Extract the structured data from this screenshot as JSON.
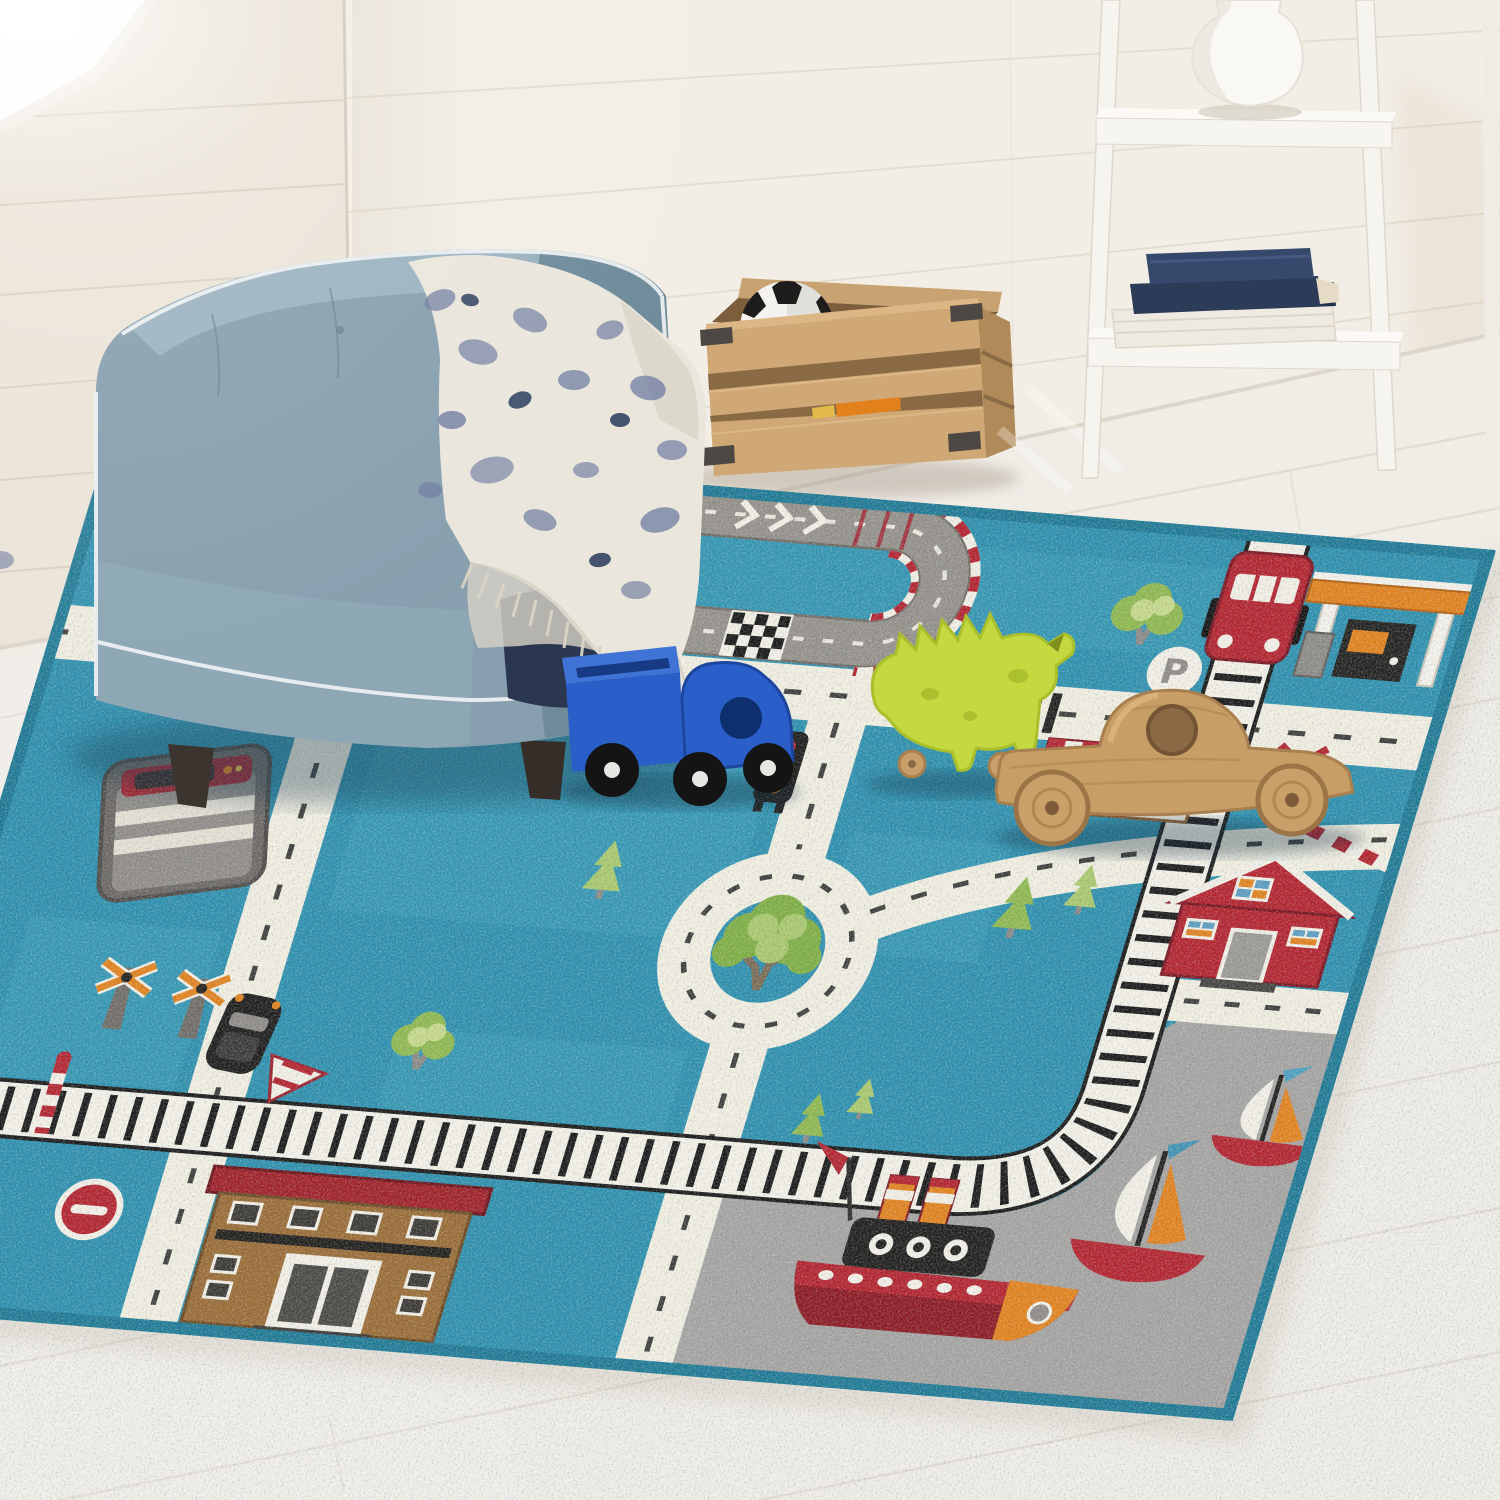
{
  "scene": {
    "label": "Photograph of a children's playroom corner: a teal road-map play rug with toy vehicles on a whitewashed wood floor, beside a light-blue tufted tub armchair with a patterned throw blanket, a wooden storage crate holding a soccer ball, and a white ladder shelf with books and a white vase against white shiplap walls",
    "room": {
      "wall_style": "white shiplap planks",
      "window": "bright daylight entering from upper left",
      "floor": "whitewashed wide wood planks"
    }
  },
  "palette": {
    "wall_left": "#ebe4d8",
    "wall_right": "#f3eee5",
    "floor": "#f0ede7",
    "chair_blue": "#879fae",
    "chair_piping": "#eceff1",
    "blanket_cream": "#eae6dc",
    "blanket_slate": "#6e7ca0",
    "blanket_navy": "#2b3750",
    "crate_wood": "#cfa876",
    "shelf_white": "#f6f4ef",
    "book_navy": "#31415f",
    "rug_teal": "#2d8fae",
    "rug_binding": "#1e7995",
    "rug_road": "#f1eee1",
    "rug_harbor_gray": "#a5a3a1",
    "race_track_gray": "#94908a",
    "accent_red": "#b3222e",
    "accent_orange": "#e2811c",
    "toy_truck_blue": "#2a5fc9",
    "toy_dino_lime": "#c3d93f",
    "toy_wood": "#c79e66"
  },
  "furniture": {
    "armchair": {
      "type": "tufted tub chair",
      "color": "#879fae",
      "feet": "dark wood"
    },
    "throw_blanket": {
      "base": "cream",
      "pattern": "slate-blue toile with fringe"
    },
    "crate": {
      "material": "natural wood slats with metal corner brackets",
      "contents": [
        "soccer ball",
        "orange toy"
      ]
    },
    "ladder_shelf": {
      "color": "white",
      "top_shelf_item": "white gourd vase",
      "lower_shelf_items": [
        "navy hardcover books",
        "cream books"
      ]
    }
  },
  "toys": {
    "truck": {
      "type": "toy dump truck",
      "color": "blue"
    },
    "dinosaur": {
      "type": "wooden rolling dinosaur",
      "color": "lime green"
    },
    "wooden_car": {
      "type": "wooden toy car",
      "color": "natural wood"
    }
  },
  "rug": {
    "field_color": "#2d8fae",
    "binding_color": "#1e7995",
    "road_color": "#f1eee1",
    "harbor_color": "#a5a3a1",
    "parking_sign_letter": "P",
    "features": [
      "gray race track with checkered finish line and red-white curbs",
      "train track with red train car",
      "gas station with orange canopy",
      "roundabout with large green tree",
      "red barn house",
      "gray harbor with tugboat and two sailboats",
      "brown school building with red roof",
      "gray bus",
      "traffic light",
      "railroad crossing signs and striped barriers",
      "no-entry sign",
      "pine and leafy trees",
      "striped shop awning",
      "zebra crossing"
    ]
  }
}
